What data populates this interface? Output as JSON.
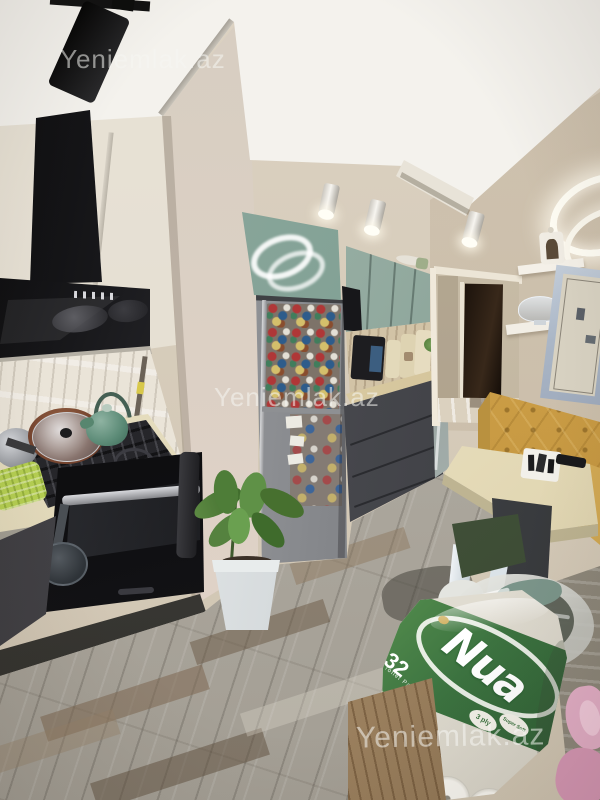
{
  "watermarks": {
    "top": "Yeniemlak.az",
    "middle": "Yeniemlak.az",
    "bottom": "Yeniemlak.az"
  },
  "package": {
    "brand": "Nua",
    "count": "32",
    "count_label": "Toilet Paper",
    "badge_ply": "3 ply",
    "badge_soft": "Super Soft"
  },
  "colors": {
    "ceiling": "#f4f2ed",
    "wall_beige": "#d8cec0",
    "pillar": "#ddd2c6",
    "upper_cabinet_green": "#8fa79c",
    "lower_cabinet_dark": "#47484d",
    "countertop_cream": "#e9e1c4",
    "range_hood_black": "#141416",
    "fridge_steel": "#8e9093",
    "floor_gray": "#b2aca1",
    "bench_yellow": "#d0a34c",
    "table_cream": "#efe7cc",
    "stool_green": "#4a5c41",
    "nua_green": "#3c7340",
    "towel_pink": "#dca1bb",
    "plant_green": "#55823f"
  }
}
